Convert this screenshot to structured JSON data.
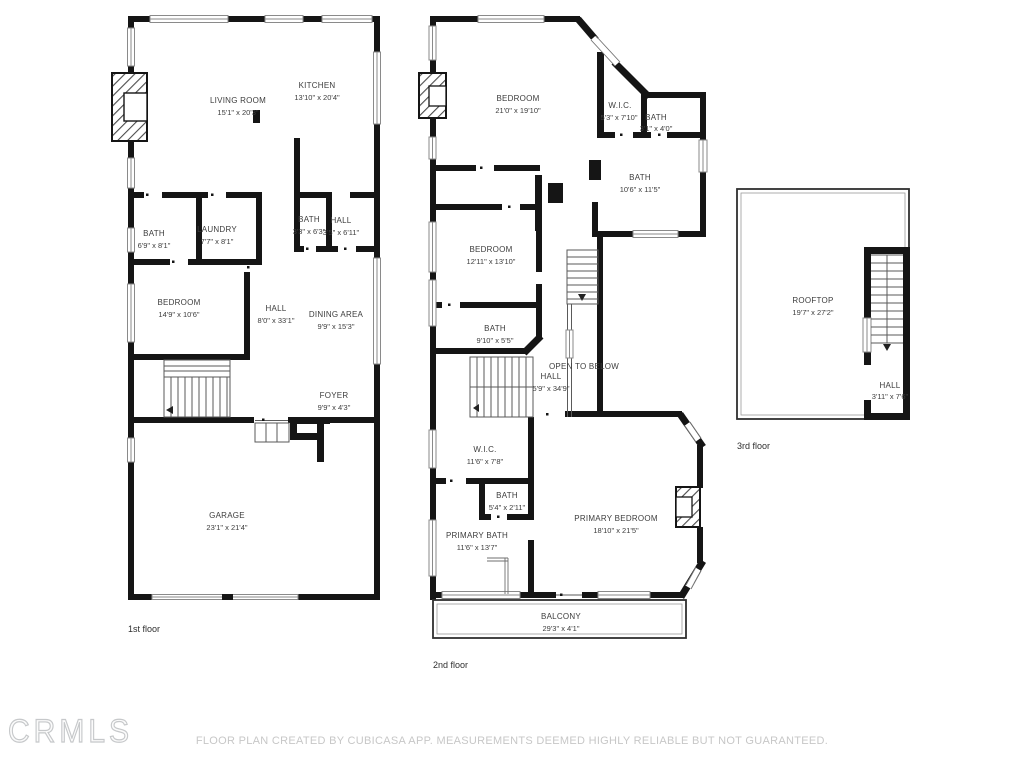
{
  "watermark": "CRMLS",
  "footer": "FLOOR PLAN CREATED BY CUBICASA APP. MEASUREMENTS DEEMED HIGHLY RELIABLE BUT NOT GUARANTEED.",
  "floors": {
    "first": {
      "label": "1st floor",
      "rooms": [
        {
          "name": "LIVING ROOM",
          "dims": "15'1\" x 20'3\""
        },
        {
          "name": "KITCHEN",
          "dims": "13'10\" x 20'4\""
        },
        {
          "name": "BATH",
          "dims": "6'9\" x 8'1\""
        },
        {
          "name": "LAUNDRY",
          "dims": "7'7\" x 8'1\""
        },
        {
          "name": "BATH",
          "dims": "3'3\" x 6'3\""
        },
        {
          "name": "HALL",
          "dims": "3'5\" x 6'11\""
        },
        {
          "name": "BEDROOM",
          "dims": "14'9\" x 10'6\""
        },
        {
          "name": "HALL",
          "dims": "8'0\" x 33'1\""
        },
        {
          "name": "DINING AREA",
          "dims": "9'9\" x 15'3\""
        },
        {
          "name": "FOYER",
          "dims": "9'9\" x 4'3\""
        },
        {
          "name": "GARAGE",
          "dims": "23'1\" x 21'4\""
        }
      ]
    },
    "second": {
      "label": "2nd floor",
      "rooms": [
        {
          "name": "BEDROOM",
          "dims": "21'0\" x 19'10\""
        },
        {
          "name": "W.I.C.",
          "dims": "5'3\" x 7'10\""
        },
        {
          "name": "BATH",
          "dims": "3'1\" x 4'0\""
        },
        {
          "name": "BATH",
          "dims": "10'6\" x 11'5\""
        },
        {
          "name": "BEDROOM",
          "dims": "12'11\" x 13'10\""
        },
        {
          "name": "BATH",
          "dims": "9'10\" x 5'5\""
        },
        {
          "name": "OPEN TO BELOW",
          "dims": ""
        },
        {
          "name": "HALL",
          "dims": "5'9\" x 34'9\""
        },
        {
          "name": "W.I.C.",
          "dims": "11'6\" x 7'8\""
        },
        {
          "name": "BATH",
          "dims": "5'4\" x 2'11\""
        },
        {
          "name": "PRIMARY BATH",
          "dims": "11'6\" x 13'7\""
        },
        {
          "name": "PRIMARY BEDROOM",
          "dims": "18'10\" x 21'5\""
        },
        {
          "name": "BALCONY",
          "dims": "29'3\" x 4'1\""
        }
      ]
    },
    "third": {
      "label": "3rd floor",
      "rooms": [
        {
          "name": "ROOFTOP",
          "dims": "19'7\" x 27'2\""
        },
        {
          "name": "HALL",
          "dims": "3'11\" x 7'6\""
        }
      ]
    }
  }
}
